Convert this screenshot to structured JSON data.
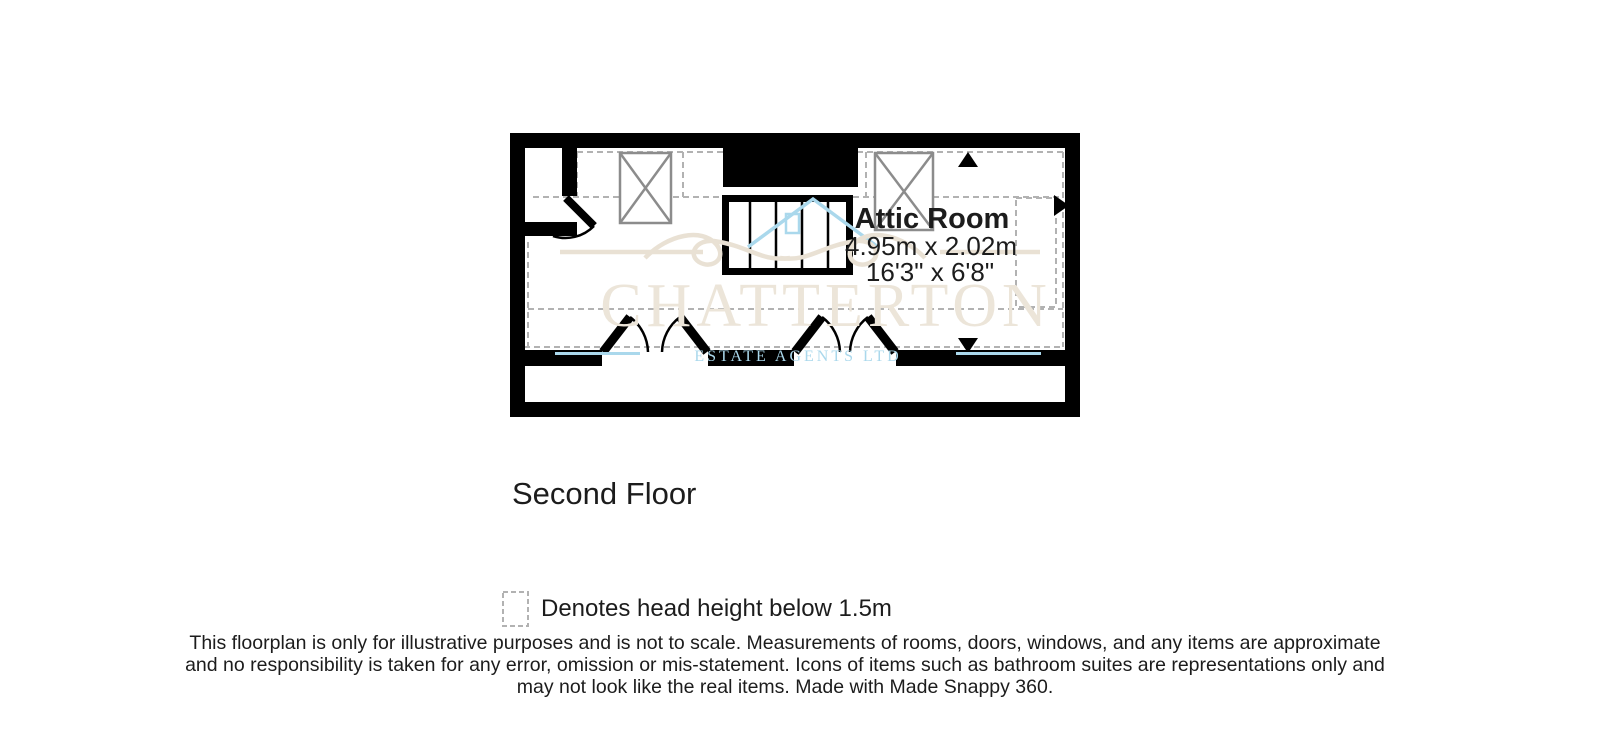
{
  "plan": {
    "room": {
      "name": "Attic Room",
      "dims_metric": "4.95m x 2.02m",
      "dims_imperial": "16'3\" x 6'8\""
    },
    "floor_label": "Second Floor"
  },
  "legend": {
    "text": "Denotes head height below 1.5m"
  },
  "disclaimer": {
    "line1": "This floorplan is only for illustrative purposes and is not to scale. Measurements of rooms, doors, windows, and any items are approximate",
    "line2": "and no responsibility is taken for any error, omission or mis-statement. Icons of items such as bathroom suites are representations only and",
    "line3": "may not look like the real items. Made with Made Snappy 360."
  },
  "watermark": {
    "name": "CHATTERTON",
    "tagline": "ESTATE AGENTS LTD"
  },
  "icons": [
    "skylight-window-icon",
    "staircase-icon",
    "door-swing-icon",
    "double-doors-icon",
    "slope-arrow-up-icon",
    "slope-arrow-right-icon",
    "slope-arrow-down-icon",
    "head-height-swatch-icon",
    "house-logo-icon"
  ],
  "colors": {
    "wall": "#000000",
    "dashed_zone": "#b2b2b2",
    "skylight_stroke": "#8c8c8c",
    "text": "#1c1c1c",
    "watermark_beige": "#e9e1d4",
    "watermark_blue": "#aad8ec"
  }
}
